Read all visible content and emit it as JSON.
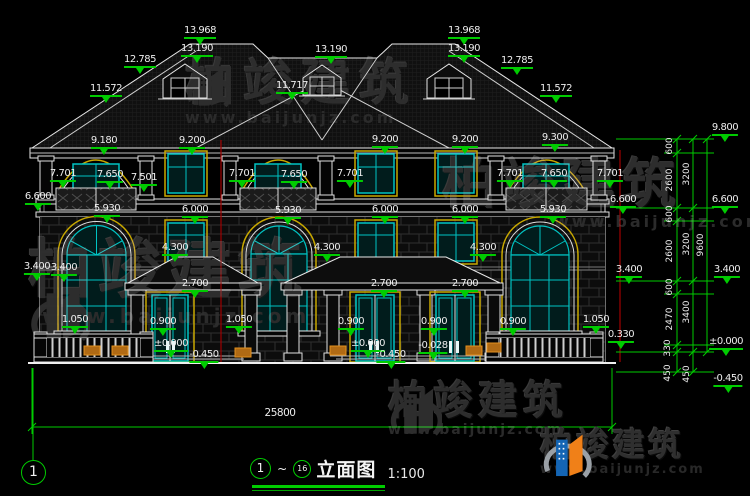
{
  "brand": {
    "name": "柏竣建筑",
    "url": "www.baijunjz.com"
  },
  "title_bar": {
    "start_no": "1",
    "tilde": "~",
    "end_no": "16",
    "name": "立面图",
    "scale": "1:100"
  },
  "axis_bubble_label": "1",
  "overall_dim_label": "25800",
  "colors": {
    "dim_green": "#00cc00",
    "window_cyan": "#00c3c3",
    "frame_yellow": "#c8a800",
    "section_red": "#a00000",
    "planter_orange": "#b06a14",
    "line_white": "#e8e8e8",
    "watermark_gray": "#2d2d2d",
    "logo_blue": "#1465b4",
    "logo_orange": "#f08018"
  },
  "elevation_marks": [
    {
      "t": "13.968",
      "x": 200,
      "y": 26
    },
    {
      "t": "13.190",
      "x": 197,
      "y": 44
    },
    {
      "t": "12.785",
      "x": 140,
      "y": 55
    },
    {
      "t": "11.572",
      "x": 106,
      "y": 84
    },
    {
      "t": "13.190",
      "x": 331,
      "y": 45
    },
    {
      "t": "11.717",
      "x": 292,
      "y": 81
    },
    {
      "t": "13.968",
      "x": 464,
      "y": 26
    },
    {
      "t": "13.190",
      "x": 464,
      "y": 44
    },
    {
      "t": "12.785",
      "x": 517,
      "y": 56
    },
    {
      "t": "11.572",
      "x": 556,
      "y": 84
    },
    {
      "t": "9.180",
      "x": 104,
      "y": 136
    },
    {
      "t": "9.200",
      "x": 192,
      "y": 136
    },
    {
      "t": "9.200",
      "x": 385,
      "y": 135
    },
    {
      "t": "9.200",
      "x": 465,
      "y": 135
    },
    {
      "t": "9.300",
      "x": 555,
      "y": 133
    },
    {
      "t": "7.701",
      "x": 63,
      "y": 169
    },
    {
      "t": "7.650",
      "x": 110,
      "y": 170
    },
    {
      "t": "7.501",
      "x": 144,
      "y": 173
    },
    {
      "t": "7.701",
      "x": 242,
      "y": 169
    },
    {
      "t": "7.650",
      "x": 294,
      "y": 170
    },
    {
      "t": "7.701",
      "x": 350,
      "y": 169
    },
    {
      "t": "7.701",
      "x": 510,
      "y": 169
    },
    {
      "t": "7.650",
      "x": 554,
      "y": 169
    },
    {
      "t": "7.701",
      "x": 610,
      "y": 169
    },
    {
      "t": "6.600",
      "x": 38,
      "y": 192
    },
    {
      "t": "6.600",
      "x": 623,
      "y": 195
    },
    {
      "t": "5.930",
      "x": 107,
      "y": 204
    },
    {
      "t": "6.000",
      "x": 195,
      "y": 205
    },
    {
      "t": "5.930",
      "x": 288,
      "y": 206
    },
    {
      "t": "6.000",
      "x": 385,
      "y": 205
    },
    {
      "t": "6.000",
      "x": 465,
      "y": 205
    },
    {
      "t": "5.930",
      "x": 553,
      "y": 205
    },
    {
      "t": "4.300",
      "x": 175,
      "y": 243
    },
    {
      "t": "4.300",
      "x": 327,
      "y": 243
    },
    {
      "t": "4.300",
      "x": 483,
      "y": 243
    },
    {
      "t": "3.400",
      "x": 37,
      "y": 262
    },
    {
      "t": "3.400",
      "x": 64,
      "y": 263
    },
    {
      "t": "3.400",
      "x": 629,
      "y": 265
    },
    {
      "t": "2.700",
      "x": 195,
      "y": 279
    },
    {
      "t": "2.700",
      "x": 384,
      "y": 279
    },
    {
      "t": "2.700",
      "x": 465,
      "y": 279
    },
    {
      "t": "1.050",
      "x": 75,
      "y": 315
    },
    {
      "t": "0.900",
      "x": 163,
      "y": 317
    },
    {
      "t": "1.050",
      "x": 239,
      "y": 315
    },
    {
      "t": "0.900",
      "x": 351,
      "y": 317
    },
    {
      "t": "0.900",
      "x": 434,
      "y": 317
    },
    {
      "t": "0.900",
      "x": 513,
      "y": 317
    },
    {
      "t": "1.050",
      "x": 596,
      "y": 315
    },
    {
      "t": "0.330",
      "x": 621,
      "y": 330
    },
    {
      "t": "±0.000",
      "x": 171,
      "y": 339
    },
    {
      "t": "-0.450",
      "x": 204,
      "y": 350
    },
    {
      "t": "±0.000",
      "x": 368,
      "y": 339
    },
    {
      "t": "-0.450",
      "x": 391,
      "y": 350
    },
    {
      "t": "-0.028",
      "x": 433,
      "y": 341
    }
  ],
  "right_chain": {
    "inner_segments": [
      {
        "t": "600",
        "x": 670,
        "y": 146
      },
      {
        "t": "2600",
        "x": 670,
        "y": 180
      },
      {
        "t": "600",
        "x": 670,
        "y": 214
      },
      {
        "t": "2600",
        "x": 670,
        "y": 251
      },
      {
        "t": "600",
        "x": 670,
        "y": 287
      },
      {
        "t": "2470",
        "x": 670,
        "y": 319
      },
      {
        "t": "330",
        "x": 668,
        "y": 348
      },
      {
        "t": "450",
        "x": 668,
        "y": 373
      }
    ],
    "mid_segments": [
      {
        "t": "3200",
        "x": 687,
        "y": 174
      },
      {
        "t": "3200",
        "x": 687,
        "y": 244
      },
      {
        "t": "3400",
        "x": 687,
        "y": 312
      },
      {
        "t": "450",
        "x": 687,
        "y": 374
      }
    ],
    "total_segment": {
      "t": "9600",
      "x": 701,
      "y": 245
    },
    "levels": [
      {
        "t": "9.800",
        "x": 725,
        "y": 123
      },
      {
        "t": "6.600",
        "x": 725,
        "y": 195
      },
      {
        "t": "3.400",
        "x": 727,
        "y": 265
      },
      {
        "t": "±0.000",
        "x": 726,
        "y": 337
      },
      {
        "t": "-0.450",
        "x": 728,
        "y": 374
      }
    ]
  }
}
